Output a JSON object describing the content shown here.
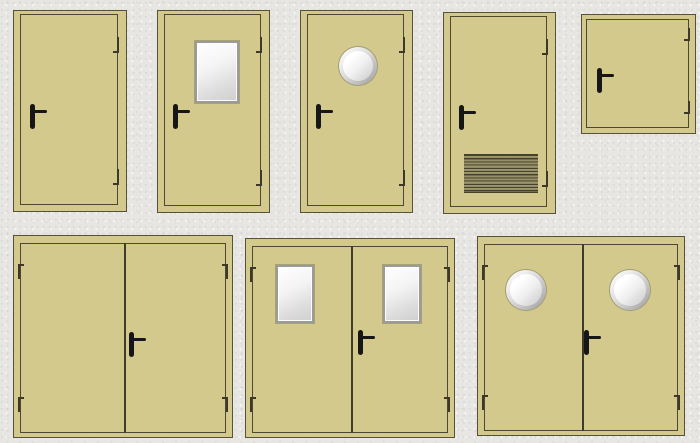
{
  "canvas": {
    "width": 700,
    "height": 443,
    "background": "#e7e6e3"
  },
  "palette": {
    "door_fill": "#d3c98c",
    "door_outline": "#56523a",
    "leaf_line": "#4c4832",
    "divider_line": "#3f3c2b",
    "hinge": "#3c392a",
    "handle": "#161616",
    "window_frame": "#9a9a9a",
    "glass_light": "#ffffff",
    "glass_dark": "#cfcfcf",
    "porthole_ring_light": "#fbfbfb",
    "porthole_ring_dark": "#a3a3a3",
    "grille_dark": "#45422e",
    "grille_light": "#a59d70"
  },
  "doors": [
    {
      "id": "single-plain",
      "desc": "single door plain",
      "x": 13,
      "y": 10,
      "w": 114,
      "h": 202,
      "kind": "single",
      "handle": {
        "x": 16,
        "y": 93
      },
      "features": []
    },
    {
      "id": "single-window",
      "desc": "single door with vision panel",
      "x": 157,
      "y": 10,
      "w": 113,
      "h": 203,
      "kind": "single",
      "handle": {
        "x": 15,
        "y": 93
      },
      "features": [
        {
          "type": "window",
          "x": 37,
          "y": 30,
          "w": 44,
          "h": 62
        }
      ]
    },
    {
      "id": "single-porthole",
      "desc": "single door with porthole",
      "x": 300,
      "y": 10,
      "w": 113,
      "h": 203,
      "kind": "single",
      "handle": {
        "x": 15,
        "y": 93
      },
      "features": [
        {
          "type": "porthole",
          "cx": 57,
          "cy": 55,
          "r": 19
        }
      ]
    },
    {
      "id": "single-louver",
      "desc": "single door with vent grille",
      "x": 443,
      "y": 12,
      "w": 113,
      "h": 202,
      "kind": "single",
      "handle": {
        "x": 15,
        "y": 92
      },
      "features": [
        {
          "type": "grille",
          "x": 20,
          "y": 141,
          "w": 74,
          "h": 39
        }
      ]
    },
    {
      "id": "hatch",
      "desc": "small access hatch",
      "x": 581,
      "y": 14,
      "w": 115,
      "h": 120,
      "kind": "hatch",
      "handle": {
        "x": 15,
        "y": 53
      },
      "features": []
    },
    {
      "id": "double-plain",
      "desc": "double door plain",
      "x": 13,
      "y": 235,
      "w": 220,
      "h": 203,
      "kind": "double",
      "centerX": 110,
      "handle": {
        "x": 115,
        "y": 96
      },
      "features": []
    },
    {
      "id": "double-window",
      "desc": "double door with vision panels",
      "x": 245,
      "y": 238,
      "w": 210,
      "h": 200,
      "kind": "double",
      "centerX": 105,
      "handle": {
        "x": 112,
        "y": 91
      },
      "features": [
        {
          "type": "window",
          "x": 30,
          "y": 26,
          "w": 38,
          "h": 58
        },
        {
          "type": "window",
          "x": 137,
          "y": 26,
          "w": 38,
          "h": 58
        }
      ]
    },
    {
      "id": "double-porthole",
      "desc": "double door with portholes",
      "x": 477,
      "y": 236,
      "w": 208,
      "h": 200,
      "kind": "double",
      "centerX": 104,
      "handle": {
        "x": 106,
        "y": 93
      },
      "features": [
        {
          "type": "porthole",
          "cx": 48,
          "cy": 53,
          "r": 20
        },
        {
          "type": "porthole",
          "cx": 152,
          "cy": 53,
          "r": 20
        }
      ]
    }
  ]
}
